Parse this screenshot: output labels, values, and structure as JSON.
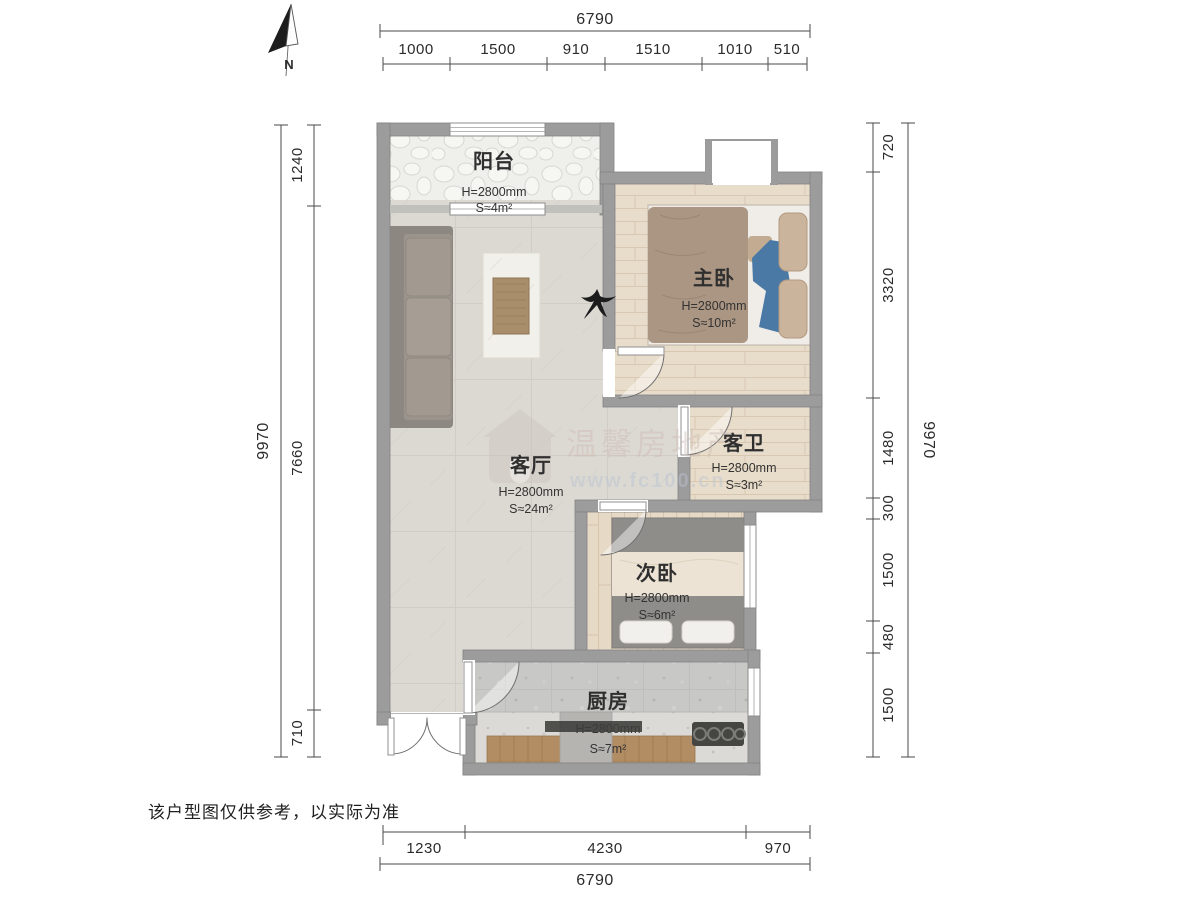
{
  "title": "户型图",
  "north_label": "N",
  "disclaimer": "该户型图仅供参考，以实际为准",
  "watermark": {
    "line1": "温馨房地产",
    "line2": "www.fc100.cn"
  },
  "rooms": [
    {
      "id": "balcony",
      "name": "阳台",
      "height": "H=2800mm",
      "area": "S≈4m²"
    },
    {
      "id": "master-bedroom",
      "name": "主卧",
      "height": "H=2800mm",
      "area": "S≈10m²"
    },
    {
      "id": "living-room",
      "name": "客厅",
      "height": "H=2800mm",
      "area": "S≈24m²"
    },
    {
      "id": "bathroom",
      "name": "客卫",
      "height": "H=2800mm",
      "area": "S≈3m²"
    },
    {
      "id": "second-bedroom",
      "name": "次卧",
      "height": "H=2800mm",
      "area": "S≈6m²"
    },
    {
      "id": "kitchen",
      "name": "厨房",
      "height": "H=2800mm",
      "area": "S≈7m²"
    }
  ],
  "dimensions": {
    "top": {
      "total": "6790",
      "segments": [
        "1000",
        "1500",
        "910",
        "1510",
        "1010",
        "510"
      ]
    },
    "bottom": {
      "total": "6790",
      "segments": [
        "1230",
        "4230",
        "970"
      ]
    },
    "left": {
      "total": "9970",
      "segments": [
        "1240",
        "7660",
        "710"
      ]
    },
    "right": {
      "total": "9970",
      "segments": [
        "720",
        "3320",
        "1480",
        "300",
        "1500",
        "480",
        "1500"
      ]
    }
  }
}
